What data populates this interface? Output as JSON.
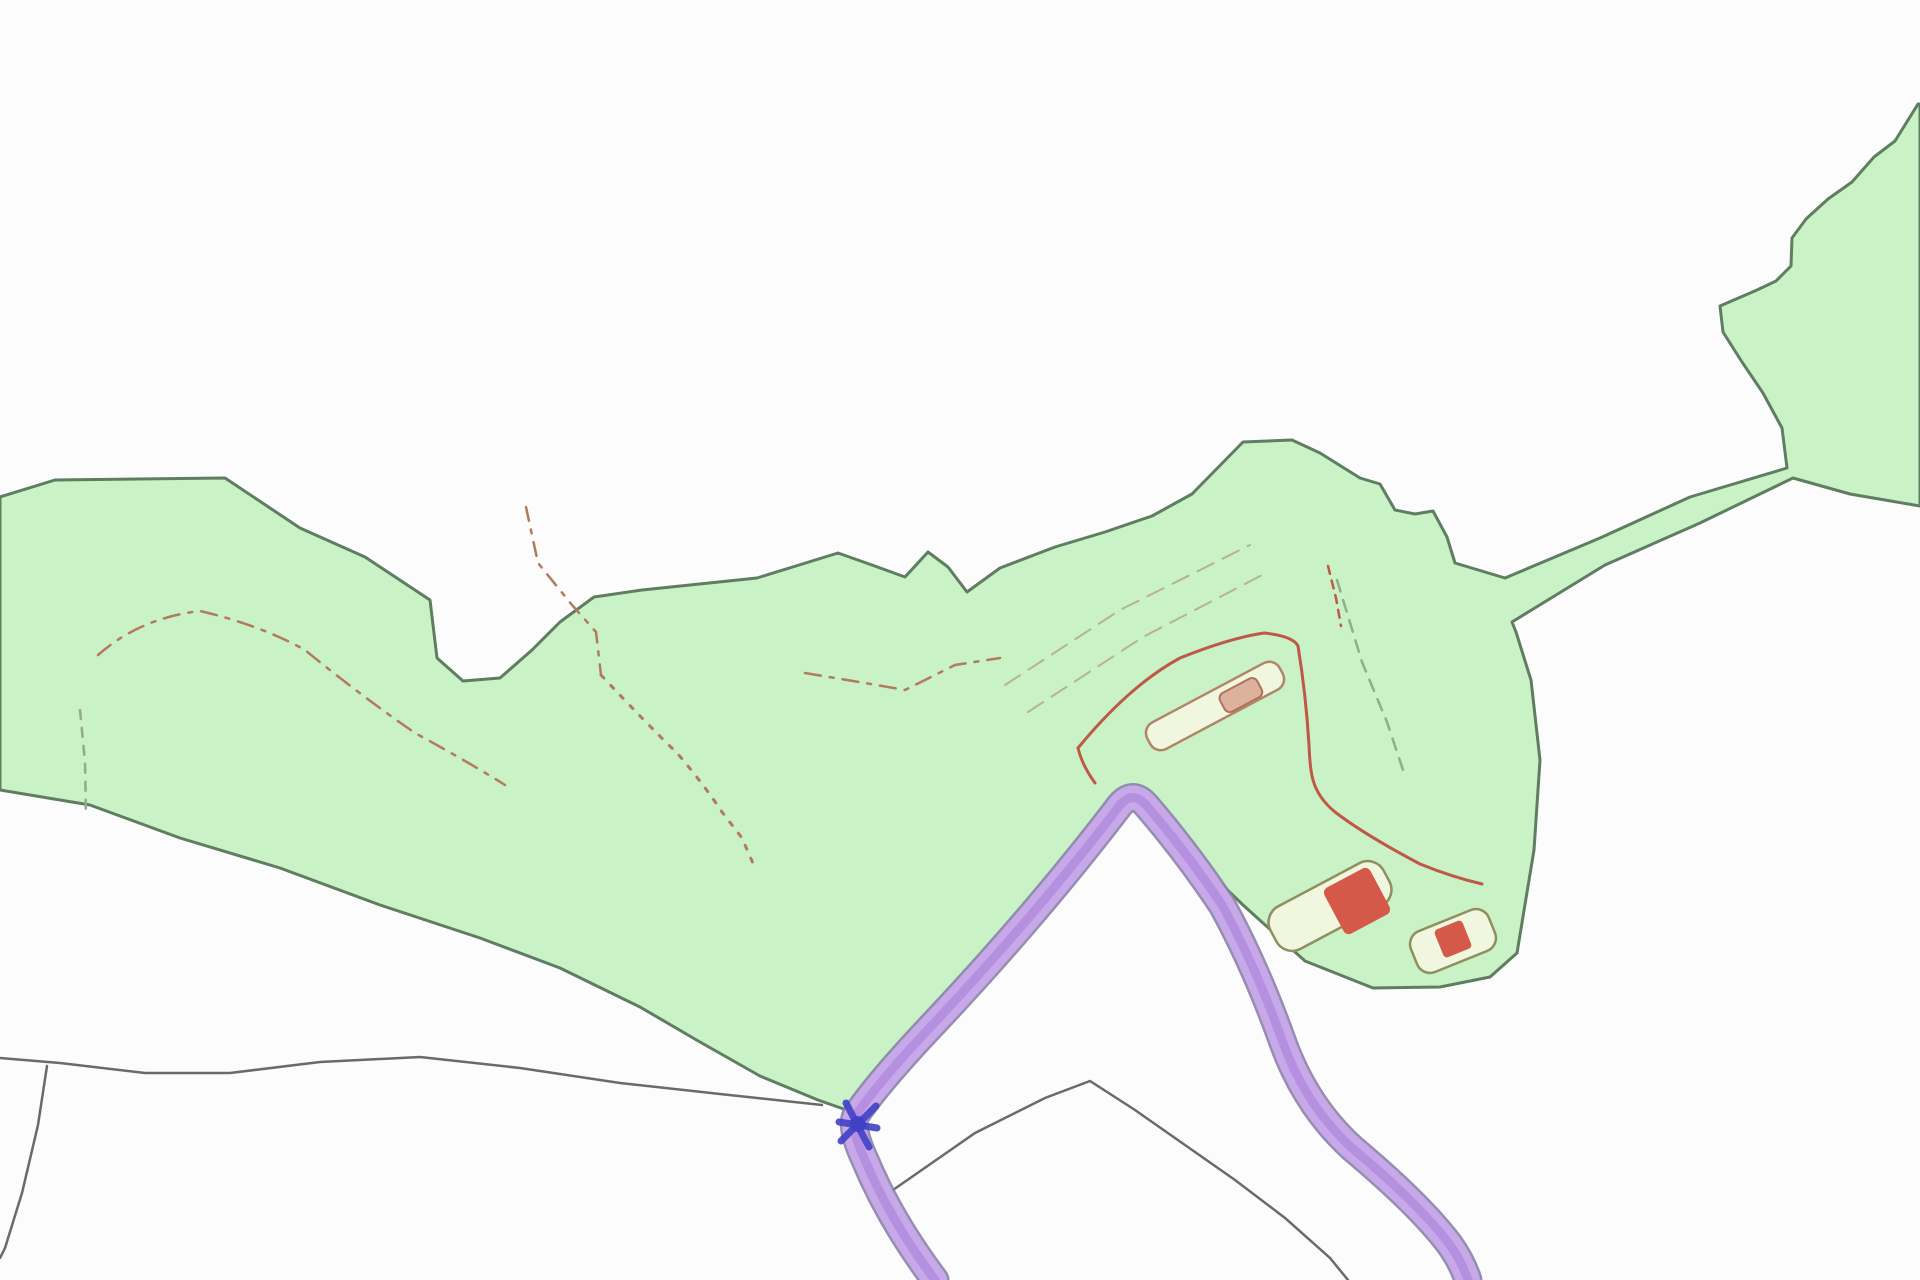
{
  "canvas": {
    "width": "1920",
    "height": "1280",
    "viewbox": "0 0 1920 1280",
    "background": "#fdfcfd"
  },
  "palette": {
    "parcel_fill": "#c9f2c6",
    "parcel_stroke": "#5f7d60",
    "field_line": "#6a6a6a",
    "track_casing": "#8a82a8",
    "track_fill": "#c7a9e9",
    "track_core": "#a57cd8",
    "marker_blue": "#4040c6",
    "enclosure_red": "#c05848",
    "building_red": "#d55948",
    "building_outline": "#8f8f5f",
    "barn_outline": "#b28468",
    "barn_fill": "#f1f6de",
    "barn_inner_fill": "#dcb29c",
    "barn_inner_stroke": "#b07258",
    "dash_red_brown": "#b37a5e",
    "dash_olive": "#93a989",
    "dash_tan": "#b3a47e",
    "dash_green": "#8fae8b"
  },
  "features": {
    "parcel": {
      "name": "green land parcel with corridor and north-east field",
      "d": "M 0 497 L 55 480 L 225 478 L 300 528 L 365 557 L 430 600 L 437 658 L 463 681 L 500 678 L 532 650 L 560 622 L 594 597 L 642 590 L 757 578 L 838 553 L 872 565 L 905 577 L 928 552 L 948 567 L 967 592 L 1000 568 L 1055 547 L 1105 532 L 1152 516 L 1192 494 L 1243 442 L 1292 440 L 1320 453 L 1360 478 L 1380 484 L 1395 510 L 1415 514 L 1433 511 L 1447 537 L 1455 563 L 1505 578 L 1600 538 L 1690 497 L 1787 468 L 1782 428 L 1763 393 L 1742 362 L 1723 332 L 1720 306 L 1757 290 L 1776 281 L 1791 266 L 1792 238 L 1806 219 L 1828 199 L 1852 182 L 1874 157 L 1895 141 L 1918 104 L 1920 104 L 1920 506 L 1850 494 L 1793 478 L 1700 523 L 1605 565 L 1512 622 L 1516 632 L 1531 680 L 1540 760 L 1534 850 L 1517 953 L 1490 977 L 1440 987 L 1373 988 L 1305 961 L 1243 905 L 1205 868 L 1160 815 L 1137 788 L 1080 860 L 1020 925 L 950 1010 L 890 1075 L 855 1113 L 818 1100 L 760 1076 L 700 1042 L 640 1007 L 560 968 L 480 938 L 380 905 L 280 868 L 180 838 L 90 805 L 0 790 Z",
      "stroke_width": "3"
    },
    "field_line_west": {
      "name": "field boundary line from west edge to track junction",
      "d": "M 0 1058 L 60 1063 L 145 1073 L 230 1073 L 320 1062 L 420 1057 L 520 1068 L 620 1083 L 720 1094 L 822 1105",
      "stroke_width": "2.5"
    },
    "field_line_southwest": {
      "name": "field boundary line to bottom-left corner",
      "d": "M 47 1066 L 38 1125 L 22 1193 L 5 1248 L 0 1258",
      "stroke_width": "2.5"
    },
    "field_line_southeast": {
      "name": "field boundary tent line right of junction",
      "d": "M 893 1190 L 975 1133 L 1045 1098 L 1090 1081 L 1135 1110 L 1185 1145 L 1235 1180 L 1285 1218 L 1330 1258 L 1348 1280",
      "stroke_width": "2.5"
    },
    "track": {
      "name": "purple highlighted access track hairpin",
      "d": "M 935 1280 Q 890 1220 865 1160 Q 850 1128 856 1115 Q 880 1080 937 1020 Q 1040 910 1120 805 Q 1133 790 1146 805 Q 1185 850 1222 905 Q 1255 965 1282 1040 Q 1305 1105 1352 1148 Q 1420 1205 1450 1245 Q 1462 1262 1468 1280",
      "casing_width": "29",
      "fill_width": "24",
      "core_width": "9"
    },
    "marker": {
      "name": "blue point marker at track junction",
      "spokes_d": "M 846 1103 L 869 1147 M 876 1106 L 841 1141 M 839 1122 L 877 1128",
      "cx": "858",
      "cy": "1124",
      "r": "8"
    },
    "enclosure": {
      "name": "red outlined enclosure around farmstead",
      "d": "M 1095 783 Q 1082 765 1078 748 Q 1130 685 1180 658 Q 1230 638 1264 633 Q 1293 636 1298 646 Q 1306 695 1309 745 Q 1310 770 1313 780 Q 1318 798 1335 812 Q 1365 835 1420 864 Q 1452 877 1482 884",
      "stroke_width": "3"
    },
    "enclosure_dash_north": {
      "name": "red dashed stub above enclosure",
      "d": "M 1328 566 L 1336 598 L 1341 626",
      "stroke_width": "2.5",
      "dasharray": "8 7"
    },
    "barn": {
      "name": "long barn footprint inside enclosure",
      "x": "1140",
      "y": "691",
      "w": "150",
      "h": "30",
      "rx": "12",
      "transform": "rotate(-28 1215 706)",
      "stroke_width": "2.5"
    },
    "barn_inner": {
      "name": "inner annexe of barn",
      "x": "1222",
      "y": "698",
      "w": "42",
      "h": "21",
      "rx": "6",
      "transform": "rotate(-28 1215 706)",
      "stroke_width": "2"
    },
    "building_a": {
      "name": "south farm building footprint",
      "x": "1266",
      "y": "882",
      "w": "128",
      "h": "48",
      "rx": "18",
      "transform": "rotate(-28 1330 906)",
      "stroke_width": "2.5"
    },
    "building_a_red": {
      "name": "red filled dwelling on south building",
      "x": "1331",
      "y": "875",
      "w": "52",
      "h": "52",
      "rx": "6",
      "transform": "rotate(-28 1357 901)"
    },
    "building_b": {
      "name": "south-east outbuilding footprint",
      "x": "1411",
      "y": "919",
      "w": "84",
      "h": "44",
      "rx": "14",
      "transform": "rotate(-22 1453 941)",
      "stroke_width": "2.5"
    },
    "building_b_red": {
      "name": "red filled core of outbuilding",
      "x": "1438",
      "y": "924",
      "w": "30",
      "h": "30",
      "rx": "4",
      "transform": "rotate(-22 1453 939)"
    },
    "path_dash_west_arc": {
      "name": "dash-dot footpath arc west",
      "d": "M 98 655 Q 140 618 200 611 Q 260 625 305 650 Q 360 695 415 733 Q 470 763 505 785",
      "stroke_width": "2.5",
      "dasharray": "16 9 4 9"
    },
    "path_dash_west_vertical": {
      "name": "short olive dashed line west",
      "d": "M 80 710 L 85 762 L 86 815",
      "stroke_width": "2.5",
      "dasharray": "9 9"
    },
    "path_dash_centre": {
      "name": "dash-dot footpath from north notch",
      "d": "M 526 507 L 538 563 L 572 605 L 596 632 L 601 675",
      "stroke_width": "2.5",
      "dasharray": "14 9 4 9"
    },
    "path_dot_centre_south": {
      "name": "dotted path toward south boundary",
      "d": "M 601 675 Q 645 722 678 754 Q 705 786 722 812 L 742 838 L 755 868",
      "stroke_width": "3",
      "dasharray": "4 10"
    },
    "path_dash_mid": {
      "name": "dash-dot footpath mid field",
      "d": "M 805 673 L 865 683 L 905 690 L 955 665 L 1000 658",
      "stroke_width": "2.5",
      "dasharray": "16 9 4 9"
    },
    "track_faint_upper": {
      "name": "faint tan track line to summit upper",
      "d": "M 1005 685 L 1120 610 L 1250 545",
      "stroke_width": "2",
      "dasharray": "18 10"
    },
    "track_faint_lower": {
      "name": "faint tan track line to summit lower",
      "d": "M 1028 712 L 1143 637 L 1268 572",
      "stroke_width": "2",
      "dasharray": "18 10"
    },
    "veg_dash_east": {
      "name": "green dashed vegetation line east",
      "d": "M 1337 580 L 1362 662 L 1387 722 L 1403 770",
      "stroke_width": "2.5",
      "dasharray": "12 9"
    }
  }
}
